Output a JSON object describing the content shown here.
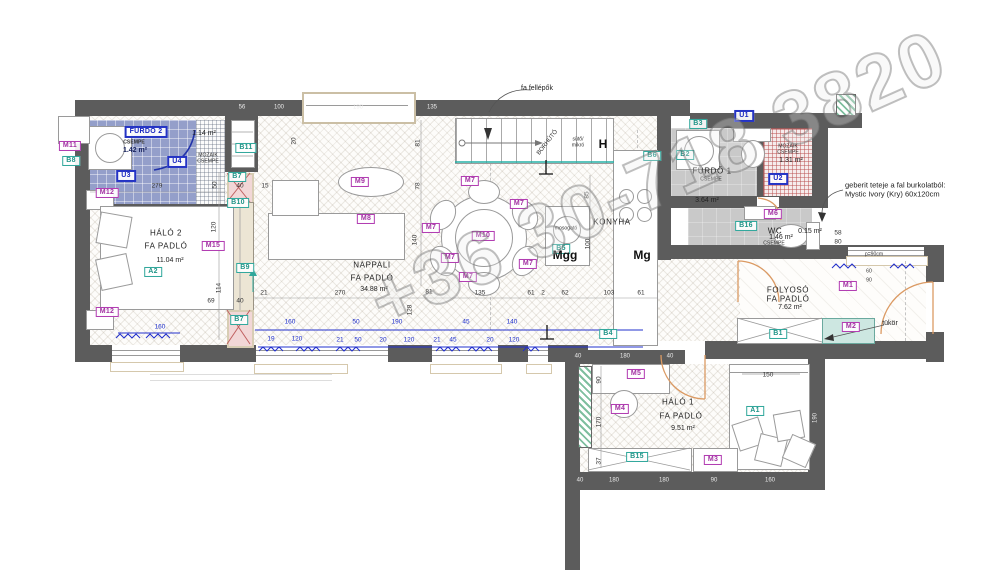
{
  "watermark": "+36 30-718 3820",
  "labels": [
    {
      "t": "M11",
      "c": "chip-m",
      "x": 70,
      "y": 146
    },
    {
      "t": "M12",
      "c": "chip-m",
      "x": 107,
      "y": 193
    },
    {
      "t": "M12",
      "c": "chip-m",
      "x": 107,
      "y": 312
    },
    {
      "t": "M15",
      "c": "chip-m",
      "x": 213,
      "y": 246
    },
    {
      "t": "M9",
      "c": "chip-m",
      "x": 360,
      "y": 182
    },
    {
      "t": "M8",
      "c": "chip-m",
      "x": 366,
      "y": 219
    },
    {
      "t": "M7",
      "c": "chip-m",
      "x": 470,
      "y": 181
    },
    {
      "t": "M7",
      "c": "chip-m",
      "x": 519,
      "y": 204
    },
    {
      "t": "M7",
      "c": "chip-m",
      "x": 431,
      "y": 228
    },
    {
      "t": "M7",
      "c": "chip-m",
      "x": 450,
      "y": 258
    },
    {
      "t": "M7",
      "c": "chip-m",
      "x": 528,
      "y": 264
    },
    {
      "t": "M7",
      "c": "chip-m",
      "x": 468,
      "y": 277
    },
    {
      "t": "M10",
      "c": "chip-m",
      "x": 483,
      "y": 236
    },
    {
      "t": "M6",
      "c": "chip-m",
      "x": 773,
      "y": 214
    },
    {
      "t": "M1",
      "c": "chip-m",
      "x": 848,
      "y": 286
    },
    {
      "t": "M2",
      "c": "chip-m",
      "x": 851,
      "y": 327
    },
    {
      "t": "M5",
      "c": "chip-m",
      "x": 636,
      "y": 374
    },
    {
      "t": "M4",
      "c": "chip-m",
      "x": 620,
      "y": 409
    },
    {
      "t": "M3",
      "c": "chip-m",
      "x": 713,
      "y": 460
    },
    {
      "t": "B8",
      "c": "chip-b",
      "x": 71,
      "y": 161
    },
    {
      "t": "A2",
      "c": "chip-b",
      "x": 153,
      "y": 272
    },
    {
      "t": "B11",
      "c": "chip-b",
      "x": 246,
      "y": 148
    },
    {
      "t": "B7",
      "c": "chip-b",
      "x": 237,
      "y": 177
    },
    {
      "t": "B10",
      "c": "chip-b",
      "x": 238,
      "y": 203
    },
    {
      "t": "B9",
      "c": "chip-b",
      "x": 245,
      "y": 268
    },
    {
      "t": "B7",
      "c": "chip-b",
      "x": 239,
      "y": 320
    },
    {
      "t": "B5",
      "c": "chip-b",
      "x": 561,
      "y": 249
    },
    {
      "t": "B6",
      "c": "chip-b",
      "x": 652,
      "y": 156
    },
    {
      "t": "B2",
      "c": "chip-b",
      "x": 685,
      "y": 155
    },
    {
      "t": "B3",
      "c": "chip-b",
      "x": 698,
      "y": 124
    },
    {
      "t": "B16",
      "c": "chip-b",
      "x": 746,
      "y": 226
    },
    {
      "t": "B4",
      "c": "chip-b",
      "x": 608,
      "y": 334
    },
    {
      "t": "B1",
      "c": "chip-b",
      "x": 778,
      "y": 334
    },
    {
      "t": "A1",
      "c": "chip-b",
      "x": 755,
      "y": 411
    },
    {
      "t": "B15",
      "c": "chip-b",
      "x": 637,
      "y": 457
    },
    {
      "t": "U3",
      "c": "chip-u",
      "x": 126,
      "y": 176
    },
    {
      "t": "U4",
      "c": "chip-u",
      "x": 177,
      "y": 162
    },
    {
      "t": "U1",
      "c": "chip-u",
      "x": 744,
      "y": 116
    },
    {
      "t": "U2",
      "c": "chip-u",
      "x": 778,
      "y": 179
    },
    {
      "t": "FÜRDŐ 2",
      "c": "chip-u",
      "x": 146,
      "y": 132
    },
    {
      "t": "HÁLÓ 2",
      "c": "room",
      "x": 166,
      "y": 233
    },
    {
      "t": "FA PADLÓ",
      "c": "room",
      "x": 166,
      "y": 246
    },
    {
      "t": "11.04 m²",
      "c": "area",
      "x": 170,
      "y": 261
    },
    {
      "t": "NAPPALI",
      "c": "room",
      "x": 372,
      "y": 265
    },
    {
      "t": "FA PADLÓ",
      "c": "room",
      "x": 372,
      "y": 278
    },
    {
      "t": "34.88 m²",
      "c": "area",
      "x": 374,
      "y": 290
    },
    {
      "t": "KONYHA",
      "c": "room",
      "x": 612,
      "y": 222
    },
    {
      "t": "FÜRDŐ 1",
      "c": "room",
      "x": 712,
      "y": 171
    },
    {
      "t": "CSEMPE",
      "c": "tiny",
      "x": 711,
      "y": 180
    },
    {
      "t": "3.64 m²",
      "c": "area",
      "x": 707,
      "y": 201
    },
    {
      "t": "CSEMPE",
      "c": "tiny navy",
      "x": 134,
      "y": 143
    },
    {
      "t": "1.42 m²",
      "c": "area navy",
      "x": 135,
      "y": 151
    },
    {
      "t": "1.14 m²",
      "c": "area",
      "x": 204,
      "y": 134
    },
    {
      "t": "MOZAIK",
      "c": "tiny",
      "x": 208,
      "y": 156
    },
    {
      "t": "CSEMPE",
      "c": "tiny",
      "x": 208,
      "y": 162
    },
    {
      "t": "MOZAIK",
      "c": "tiny",
      "x": 788,
      "y": 147
    },
    {
      "t": "CSEMPE",
      "c": "tiny",
      "x": 788,
      "y": 153
    },
    {
      "t": "1.31 m²",
      "c": "area",
      "x": 791,
      "y": 161
    },
    {
      "t": "WC",
      "c": "room",
      "x": 775,
      "y": 231
    },
    {
      "t": "1.46 m²",
      "c": "area",
      "x": 781,
      "y": 238
    },
    {
      "t": "CSEMPE",
      "c": "tiny",
      "x": 774,
      "y": 244
    },
    {
      "t": "0.15 m²",
      "c": "area",
      "x": 810,
      "y": 232
    },
    {
      "t": "FOLYOSÓ",
      "c": "room",
      "x": 788,
      "y": 290
    },
    {
      "t": "FA PADLÓ",
      "c": "room",
      "x": 788,
      "y": 299
    },
    {
      "t": "7.62 m²",
      "c": "area",
      "x": 790,
      "y": 308
    },
    {
      "t": "HÁLÓ 1",
      "c": "room",
      "x": 678,
      "y": 402
    },
    {
      "t": "FA PADLÓ",
      "c": "room",
      "x": 681,
      "y": 416
    },
    {
      "t": "9.51 m²",
      "c": "area",
      "x": 683,
      "y": 429
    },
    {
      "t": "Mgg",
      "c": "big",
      "x": 565,
      "y": 256
    },
    {
      "t": "Mg",
      "c": "big",
      "x": 642,
      "y": 256
    },
    {
      "t": "H",
      "c": "big",
      "x": 603,
      "y": 145
    },
    {
      "t": "sütő/",
      "c": "tiny",
      "x": 578,
      "y": 140
    },
    {
      "t": "mikró",
      "c": "tiny",
      "x": 578,
      "y": 146
    },
    {
      "t": "mosogató",
      "c": "tiny",
      "x": 566,
      "y": 229
    },
    {
      "t": "BORHŰTŐ",
      "c": "tiny",
      "x": 548,
      "y": 143,
      "r": -52
    },
    {
      "t": "fa fellépők",
      "c": "area",
      "x": 537,
      "y": 89
    },
    {
      "t": "tükör",
      "c": "area",
      "x": 890,
      "y": 324
    },
    {
      "t": "p=90cm",
      "c": "tiny",
      "x": 874,
      "y": 255
    },
    {
      "t": "geberit teteje a fal burkolatból:",
      "c": "note",
      "x": 845,
      "y": 186
    },
    {
      "t": "Mystic Ivory (Kry) 60x120cm",
      "c": "note",
      "x": 845,
      "y": 195
    },
    {
      "t": "279",
      "c": "dim",
      "x": 157,
      "y": 186
    },
    {
      "t": "15",
      "c": "dim",
      "x": 265,
      "y": 186
    },
    {
      "t": "50",
      "c": "dim",
      "x": 215,
      "y": 185,
      "r": -90
    },
    {
      "t": "20",
      "c": "dim",
      "x": 294,
      "y": 141,
      "r": -90
    },
    {
      "t": "120",
      "c": "dim",
      "x": 214,
      "y": 227,
      "r": -90
    },
    {
      "t": "114",
      "c": "dim",
      "x": 219,
      "y": 288,
      "r": -90
    },
    {
      "t": "69",
      "c": "dim",
      "x": 211,
      "y": 301
    },
    {
      "t": "40",
      "c": "dim",
      "x": 240,
      "y": 301
    },
    {
      "t": "40",
      "c": "dim",
      "x": 240,
      "y": 186
    },
    {
      "t": "21",
      "c": "dim",
      "x": 264,
      "y": 293
    },
    {
      "t": "270",
      "c": "dim",
      "x": 340,
      "y": 293
    },
    {
      "t": "81",
      "c": "dim",
      "x": 429,
      "y": 292
    },
    {
      "t": "135",
      "c": "dim",
      "x": 480,
      "y": 293
    },
    {
      "t": "61",
      "c": "dim",
      "x": 531,
      "y": 293
    },
    {
      "t": "2",
      "c": "dim",
      "x": 543,
      "y": 293
    },
    {
      "t": "62",
      "c": "dim",
      "x": 565,
      "y": 293
    },
    {
      "t": "103",
      "c": "dim",
      "x": 609,
      "y": 293
    },
    {
      "t": "61",
      "c": "dim",
      "x": 641,
      "y": 293
    },
    {
      "t": "81",
      "c": "dim",
      "x": 418,
      "y": 143,
      "r": -90
    },
    {
      "t": "78",
      "c": "dim",
      "x": 418,
      "y": 186,
      "r": -90
    },
    {
      "t": "140",
      "c": "dim",
      "x": 415,
      "y": 240,
      "r": -90
    },
    {
      "t": "85",
      "c": "dim",
      "x": 587,
      "y": 195,
      "r": -90
    },
    {
      "t": "100",
      "c": "dim",
      "x": 588,
      "y": 244,
      "r": -90
    },
    {
      "t": "128",
      "c": "dim",
      "x": 410,
      "y": 310,
      "r": -90
    },
    {
      "t": "150",
      "c": "dim",
      "x": 768,
      "y": 375
    },
    {
      "t": "90",
      "c": "dim",
      "x": 599,
      "y": 380,
      "r": -90
    },
    {
      "t": "170",
      "c": "dim",
      "x": 599,
      "y": 422,
      "r": -90
    },
    {
      "t": "37",
      "c": "dim",
      "x": 599,
      "y": 461,
      "r": -90
    },
    {
      "t": "58",
      "c": "dim",
      "x": 838,
      "y": 233
    },
    {
      "t": "80",
      "c": "dim",
      "x": 838,
      "y": 242
    },
    {
      "t": "60",
      "c": "tiny",
      "x": 869,
      "y": 272
    },
    {
      "t": "90",
      "c": "tiny",
      "x": 869,
      "y": 281
    },
    {
      "t": "56",
      "c": "dimw",
      "x": 242,
      "y": 108
    },
    {
      "t": "100",
      "c": "dimw",
      "x": 279,
      "y": 108
    },
    {
      "t": "190",
      "c": "dimw",
      "x": 358,
      "y": 108
    },
    {
      "t": "135",
      "c": "dimw",
      "x": 432,
      "y": 108
    },
    {
      "t": "40",
      "c": "dimw",
      "x": 578,
      "y": 357
    },
    {
      "t": "180",
      "c": "dimw",
      "x": 625,
      "y": 357
    },
    {
      "t": "40",
      "c": "dimw",
      "x": 670,
      "y": 357
    },
    {
      "t": "40",
      "c": "dimw",
      "x": 580,
      "y": 481
    },
    {
      "t": "180",
      "c": "dimw",
      "x": 614,
      "y": 481
    },
    {
      "t": "180",
      "c": "dimw",
      "x": 664,
      "y": 481
    },
    {
      "t": "90",
      "c": "dimw",
      "x": 714,
      "y": 481
    },
    {
      "t": "160",
      "c": "dimw",
      "x": 770,
      "y": 481
    },
    {
      "t": "190",
      "c": "dimw",
      "x": 816,
      "y": 418,
      "r": -90
    },
    {
      "t": "160",
      "c": "dimb",
      "x": 160,
      "y": 327
    },
    {
      "t": "160",
      "c": "dimb",
      "x": 290,
      "y": 322
    },
    {
      "t": "19",
      "c": "dimb",
      "x": 271,
      "y": 339
    },
    {
      "t": "120",
      "c": "dimb",
      "x": 297,
      "y": 339
    },
    {
      "t": "50",
      "c": "dimb",
      "x": 356,
      "y": 322
    },
    {
      "t": "190",
      "c": "dimb",
      "x": 397,
      "y": 322
    },
    {
      "t": "45",
      "c": "dimb",
      "x": 466,
      "y": 322
    },
    {
      "t": "140",
      "c": "dimb",
      "x": 512,
      "y": 322
    },
    {
      "t": "21",
      "c": "dimb",
      "x": 340,
      "y": 340
    },
    {
      "t": "50",
      "c": "dimb",
      "x": 358,
      "y": 340
    },
    {
      "t": "20",
      "c": "dimb",
      "x": 383,
      "y": 340
    },
    {
      "t": "120",
      "c": "dimb",
      "x": 409,
      "y": 340
    },
    {
      "t": "21",
      "c": "dimb",
      "x": 437,
      "y": 340
    },
    {
      "t": "45",
      "c": "dimb",
      "x": 453,
      "y": 340
    },
    {
      "t": "20",
      "c": "dimb",
      "x": 490,
      "y": 340
    },
    {
      "t": "120",
      "c": "dimb",
      "x": 514,
      "y": 340
    }
  ]
}
